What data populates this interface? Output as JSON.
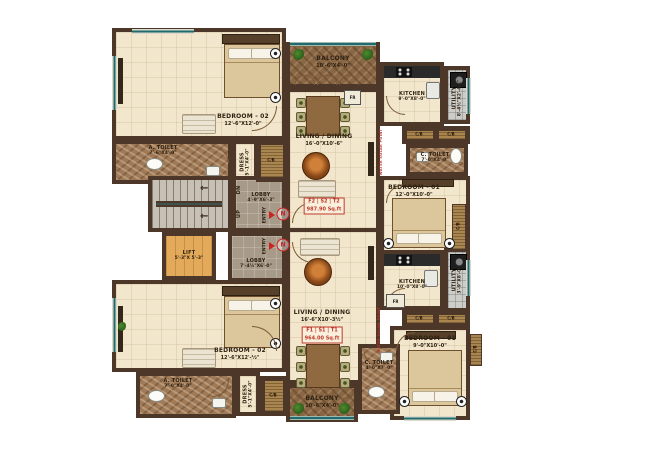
{
  "colors": {
    "wall": "#4c3728",
    "floor_cream": "#f2e7cd",
    "accent_red": "#c0392b",
    "teal_rail": "#1f6b6e",
    "lift_wood": "#e3aa5b",
    "balcony_wood": "#8a6744",
    "toilet_marble": "#a07a56",
    "lobby_gray": "#a79a88"
  },
  "core": {
    "stairs": {
      "dn": "DN",
      "up": "UP"
    },
    "lift": {
      "name": "LIFT",
      "dim": "5'-3\"X 5'-3\""
    },
    "lobby_upper": {
      "name": "LOBBY",
      "dim": "4'-9\"X6'-3\""
    },
    "lobby_lower": {
      "name": "LOBBY",
      "dim": "7'-4½\"X6'-0\""
    },
    "entry_label": "ENTRY",
    "north_label": "N"
  },
  "unit_upper": {
    "badge": {
      "flats": "F2 | S2 | T2",
      "area": "987.90 Sq.ft"
    },
    "balcony": {
      "name": "BALCONY",
      "dim": "10'-6\"X4'-0\""
    },
    "living": {
      "name": "LIVING / DINING",
      "dim": "16'-0\"X10'-6\""
    },
    "bedroom2": {
      "name": "BEDROOM - 02",
      "dim": "12'-6\"X12'-0\""
    },
    "bedroom1": {
      "name": "BEDROOM - 01",
      "dim": "12'-0\"X10'-0\""
    },
    "kitchen": {
      "name": "KITCHEN",
      "dim": "9'-0\"X8'-0\""
    },
    "utility": {
      "name": "UTILITY",
      "dim": "8'-4½\"X2'-4½\""
    },
    "a_toilet": {
      "name": "A. TOILET",
      "dim": "7'-6\"X4'-0\""
    },
    "c_toilet": {
      "name": "C. TOILET",
      "dim": "7'-0\"X4'-0\""
    },
    "dress": {
      "name": "DRESS",
      "dim": "5'-1\"X4'-0\""
    },
    "cb": "C/B",
    "fridge": "FR",
    "note": "WATER SOLAR POINT"
  },
  "unit_lower": {
    "badge": {
      "flats": "F1 | S1 | T1",
      "area": "964.00 Sq.ft"
    },
    "balcony": {
      "name": "BALCONY",
      "dim": "10'-6\"X4'-0\""
    },
    "living": {
      "name": "LIVING / DINING",
      "dim": "16'-6\"X10'-3½\""
    },
    "bedroom2": {
      "name": "BEDROOM - 02",
      "dim": "12'-6\"X12'-½\""
    },
    "bedroom1": {
      "name": "BEDROOM - 01",
      "dim": "9'-0\"X10'-0\""
    },
    "kitchen": {
      "name": "KITCHEN",
      "dim": "10'-0\"X8'-0\""
    },
    "utility": {
      "name": "UTILITY",
      "dim": "3'-9\"X8'-0\""
    },
    "a_toilet": {
      "name": "A. TOILET",
      "dim": "7'-0\"X4'-0\""
    },
    "c_toilet": {
      "name": "C. TOILET",
      "dim": "4'-0\"X7'-0\""
    },
    "dress": {
      "name": "DRESS",
      "dim": "5'-1\"X4'-0\""
    },
    "cb": "C/B",
    "fridge": "FR",
    "note": "WATER SOLAR POINT"
  }
}
